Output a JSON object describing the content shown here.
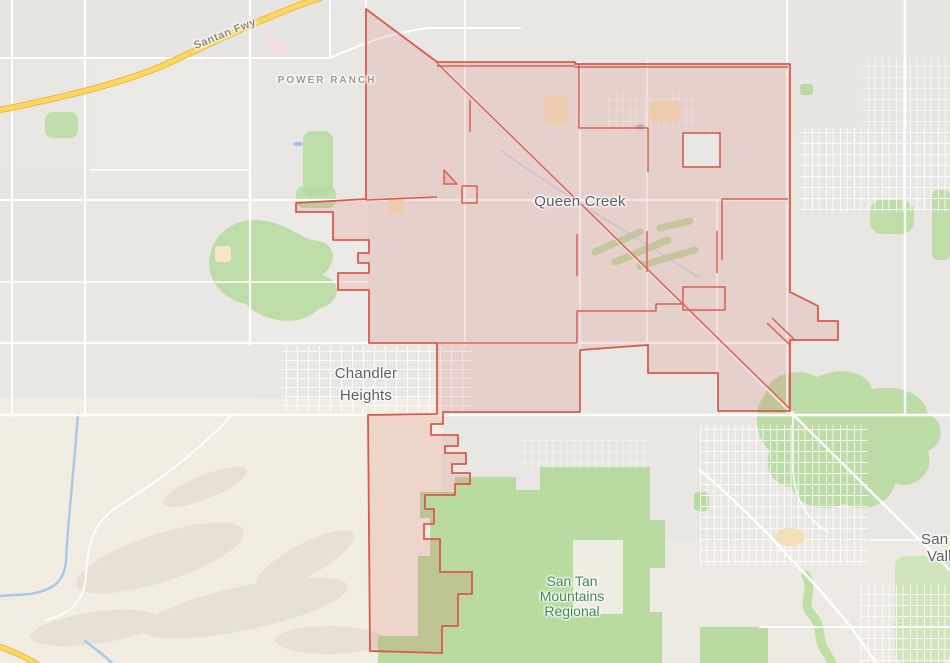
{
  "map": {
    "labels": {
      "santan_fwy": "Santan Fwy",
      "power_ranch": "POWER RANCH",
      "queen_creek": "Queen Creek",
      "chandler_heights_line1": "Chandler",
      "chandler_heights_line2": "Heights",
      "san_tan_park_line1": "San Tan",
      "san_tan_park_line2": "Mountains",
      "san_tan_park_line3": "Regional",
      "san_tan_valley_line1": "San Tan",
      "san_tan_valley_line2": "Valley"
    },
    "colors": {
      "boundary_stroke": "#d95a4c",
      "boundary_fill": "#f0dcd7",
      "base_gray": "#e9e7e3",
      "desert_tan": "#f1ede2",
      "park_green": "#b9dba2",
      "road_white": "#ffffff",
      "highway_yellow": "#fdd85f",
      "highway_casing": "#e8b84b",
      "water_blue": "#a8c8e8",
      "city_label_gray": "#5c5f63",
      "park_label_green": "#3d8b52",
      "neighborhood_label_gray": "#9d9a8d"
    }
  }
}
